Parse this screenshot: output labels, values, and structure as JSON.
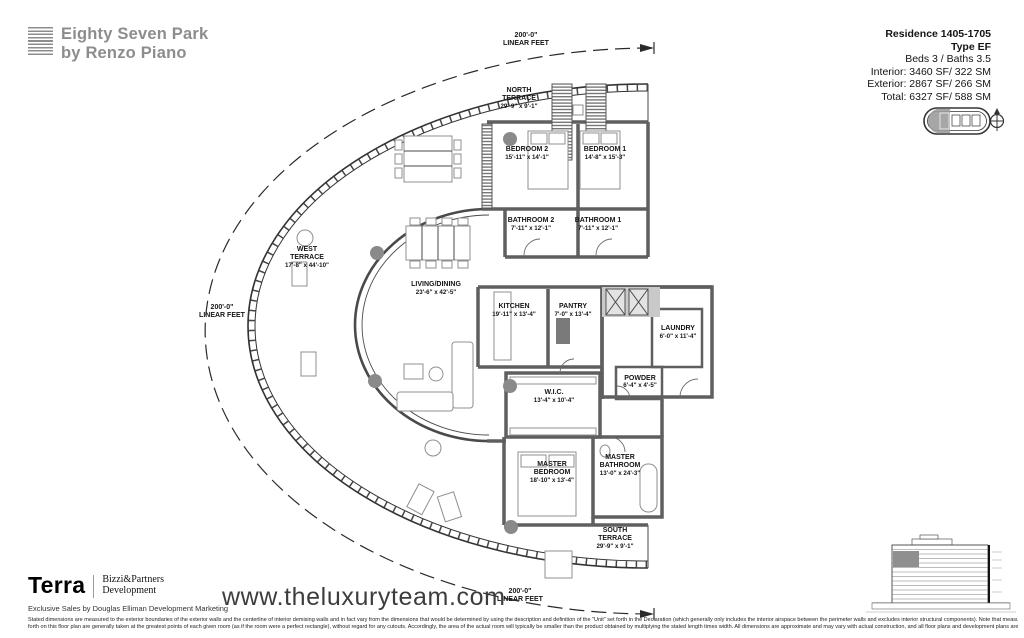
{
  "brand": {
    "line1": "Eighty Seven Park",
    "line2": "by Renzo Piano"
  },
  "residence": {
    "title": "Residence 1405-1705",
    "type": "Type EF",
    "beds_baths": "Beds 3 / Baths 3.5",
    "interior": "Interior: 3460 SF/ 322 SM",
    "exterior": "Exterior: 2867 SF/ 266 SM",
    "total": "Total: 6327 SF/ 588 SM"
  },
  "plan": {
    "linear_feet": {
      "value": "200'-0\"",
      "label": "LINEAR FEET"
    },
    "rooms": {
      "north_terrace": {
        "name_lines": [
          "NORTH",
          "TERRACE"
        ],
        "dims": "29'-9\" x 9'-1\""
      },
      "west_terrace": {
        "name_lines": [
          "WEST",
          "TERRACE"
        ],
        "dims": "17'-8\" x 44'-10\""
      },
      "south_terrace": {
        "name_lines": [
          "SOUTH",
          "TERRACE"
        ],
        "dims": "29'-9\" x 9'-1\""
      },
      "bedroom2": {
        "name_lines": [
          "BEDROOM 2"
        ],
        "dims": "15'-11\" x 14'-1\""
      },
      "bedroom1": {
        "name_lines": [
          "BEDROOM 1"
        ],
        "dims": "14'-8\" x 15'-3\""
      },
      "bathroom2": {
        "name_lines": [
          "BATHROOM 2"
        ],
        "dims": "7'-11\" x 12'-1\""
      },
      "bathroom1": {
        "name_lines": [
          "BATHROOM 1"
        ],
        "dims": "7'-11\" x 12'-1\""
      },
      "living_dining": {
        "name_lines": [
          "LIVING/DINING"
        ],
        "dims": "23'-6\" x 42'-5\""
      },
      "kitchen": {
        "name_lines": [
          "KITCHEN"
        ],
        "dims": "19'-11\" x 13'-4\""
      },
      "pantry": {
        "name_lines": [
          "PANTRY"
        ],
        "dims": "7'-0\" x 13'-4\""
      },
      "laundry": {
        "name_lines": [
          "LAUNDRY"
        ],
        "dims": "6'-0\" x 11'-4\""
      },
      "powder": {
        "name_lines": [
          "POWDER"
        ],
        "dims": "6'-4\" x 4'-5\""
      },
      "wic": {
        "name_lines": [
          "W.I.C."
        ],
        "dims": "13'-4\" x 10'-4\""
      },
      "master_bedroom": {
        "name_lines": [
          "MASTER",
          "BEDROOM"
        ],
        "dims": "18'-10\" x 13'-4\""
      },
      "master_bathroom": {
        "name_lines": [
          "MASTER",
          "BATHROOM"
        ],
        "dims": "13'-0\" x 24'-3\""
      }
    }
  },
  "footer": {
    "terra": "Terra",
    "partner_line1": "Bizzi&Partners",
    "partner_line2": "Development",
    "exclusive": "Exclusive Sales by Douglas Elliman Development Marketing",
    "url": "www.theluxuryteam.com",
    "disclaimer_line1": "Stated dimensions are measured to the exterior boundaries of the exterior walls and the centerline of interior demising walls and in fact vary from the dimensions that would be determined by using the description and definition of the \"Unit\" set forth in the Declaration (which generally only includes the interior airspace between the perimeter walls and excludes interior structural components). Note that measurements of rooms set",
    "disclaimer_line2": "forth on this floor plan are generally taken at the greatest points of each given room (as if the room were a perfect rectangle), without regard for any cutouts.  Accordingly, the area of the actual room will typically be smaller than the product obtained by multiplying the stated length times width.  All dimensions are approximate and may vary with actual construction, and all floor plans and development plans are subject to change."
  },
  "colors": {
    "brand_gray": "#8d8d8d",
    "line_dark": "#3a3a3a",
    "wall_gray": "#5f5f5f",
    "highlight_gray": "#9c9c9c"
  }
}
